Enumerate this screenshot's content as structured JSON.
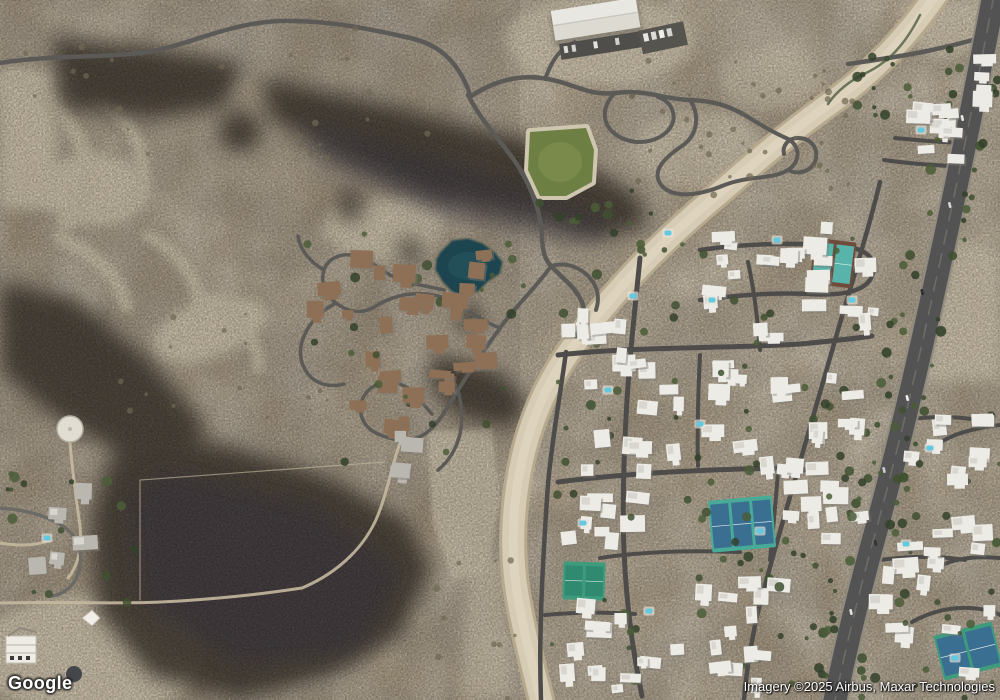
{
  "watermark": {
    "logo_text": "Google"
  },
  "attribution": {
    "text": "Imagery ©2025 Airbus, Maxar Technologies"
  },
  "colors": {
    "desert": "#b4a286",
    "desert_light": "#c7b99e",
    "sand": "#d5cab3",
    "mountain": "#453d34",
    "mountain_tint": "#3e3a46",
    "road": "#5b5a57",
    "road_dark": "#4d4c4a",
    "dirt_road": "#c6b99f",
    "wash": "#d6cbb4",
    "wash_edge": "#b6a98e",
    "highway": "#535353",
    "highway_shoulder": "#8f8b80",
    "lake": "#1c4450",
    "lake_light": "#2a5a64",
    "pool": "#62c9e0",
    "park": "#6e7f44",
    "tree": "#3f5030",
    "scrub": "#6d6753",
    "building": "#ecebe6",
    "building_shadow": "#7e7b74",
    "roof_brown": "#8d7055",
    "roof_gray": "#b9b7b0"
  },
  "map_features": {
    "residential_clusters": [
      {
        "x": 905,
        "y": 100,
        "w": 62,
        "h": 64,
        "n": 9
      },
      {
        "x": 966,
        "y": 52,
        "w": 32,
        "h": 58,
        "n": 4
      },
      {
        "x": 695,
        "y": 216,
        "w": 185,
        "h": 132,
        "n": 22
      },
      {
        "x": 560,
        "y": 298,
        "w": 132,
        "h": 118,
        "n": 14
      },
      {
        "x": 698,
        "y": 358,
        "w": 178,
        "h": 118,
        "n": 20
      },
      {
        "x": 556,
        "y": 416,
        "w": 138,
        "h": 138,
        "n": 15
      },
      {
        "x": 778,
        "y": 478,
        "w": 92,
        "h": 88,
        "n": 9
      },
      {
        "x": 550,
        "y": 598,
        "w": 112,
        "h": 98,
        "n": 12
      },
      {
        "x": 663,
        "y": 563,
        "w": 128,
        "h": 132,
        "n": 14
      },
      {
        "x": 903,
        "y": 388,
        "w": 97,
        "h": 102,
        "n": 10
      },
      {
        "x": 868,
        "y": 505,
        "w": 132,
        "h": 195,
        "n": 16
      }
    ],
    "mansion_clusters": [
      {
        "x": 332,
        "y": 238,
        "w": 205,
        "h": 98,
        "n": 13,
        "roof": "brown"
      },
      {
        "x": 348,
        "y": 334,
        "w": 165,
        "h": 102,
        "n": 9,
        "roof": "brown"
      },
      {
        "x": 272,
        "y": 278,
        "w": 72,
        "h": 42,
        "n": 3,
        "roof": "brown"
      },
      {
        "x": 362,
        "y": 428,
        "w": 100,
        "h": 52,
        "n": 4,
        "roof": "gray"
      },
      {
        "x": 330,
        "y": 352,
        "w": 150,
        "h": 60,
        "n": 5,
        "roof": "brown"
      },
      {
        "x": 8,
        "y": 482,
        "w": 100,
        "h": 95,
        "n": 5,
        "roof": "gray"
      }
    ],
    "tree_zones": [
      {
        "x": 896,
        "y": 30,
        "w": 100,
        "h": 670,
        "n": 70,
        "type": "hwy"
      },
      {
        "x": 552,
        "y": 235,
        "w": 330,
        "h": 450,
        "n": 85,
        "type": "tree"
      },
      {
        "x": 856,
        "y": 48,
        "w": 86,
        "h": 72,
        "n": 14,
        "type": "tree"
      },
      {
        "x": 536,
        "y": 188,
        "w": 120,
        "h": 72,
        "n": 14,
        "type": "tree"
      },
      {
        "x": 618,
        "y": 58,
        "w": 235,
        "h": 150,
        "n": 40,
        "type": "scrub"
      },
      {
        "x": 0,
        "y": 28,
        "w": 430,
        "h": 130,
        "n": 26,
        "type": "scrub"
      },
      {
        "x": 298,
        "y": 228,
        "w": 235,
        "h": 255,
        "n": 26,
        "type": "tree"
      },
      {
        "x": 0,
        "y": 468,
        "w": 145,
        "h": 135,
        "n": 16,
        "type": "tree"
      },
      {
        "x": 884,
        "y": 378,
        "w": 116,
        "h": 322,
        "n": 30,
        "type": "tree"
      },
      {
        "x": 430,
        "y": 560,
        "w": 90,
        "h": 140,
        "n": 10,
        "type": "scrub"
      },
      {
        "x": 86,
        "y": 300,
        "w": 250,
        "h": 120,
        "n": 18,
        "type": "scrub"
      }
    ],
    "pools": [
      {
        "x": 633,
        "y": 296
      },
      {
        "x": 668,
        "y": 233
      },
      {
        "x": 700,
        "y": 424
      },
      {
        "x": 760,
        "y": 531
      },
      {
        "x": 649,
        "y": 611
      },
      {
        "x": 583,
        "y": 523
      },
      {
        "x": 906,
        "y": 544
      },
      {
        "x": 921,
        "y": 130
      },
      {
        "x": 608,
        "y": 390
      },
      {
        "x": 852,
        "y": 300
      },
      {
        "x": 47,
        "y": 538
      },
      {
        "x": 777,
        "y": 240
      },
      {
        "x": 955,
        "y": 658
      },
      {
        "x": 930,
        "y": 448
      },
      {
        "x": 712,
        "y": 300
      }
    ],
    "tennis_courts": [
      {
        "x": 812,
        "y": 240,
        "w": 42,
        "h": 46,
        "rot": 7,
        "pad": "#6f4b3c",
        "court": "#58b4ab",
        "n": 2
      },
      {
        "x": 710,
        "y": 498,
        "w": 64,
        "h": 52,
        "rot": -5,
        "pad": "#47ab97",
        "court": "#3a6f92",
        "n": 3
      },
      {
        "x": 563,
        "y": 562,
        "w": 42,
        "h": 38,
        "rot": 2,
        "pad": "#3e9c7d",
        "court": "#2f8a70",
        "n": 2
      },
      {
        "x": 938,
        "y": 628,
        "w": 60,
        "h": 46,
        "rot": -14,
        "pad": "#3e9c7d",
        "court": "#3a6f92",
        "n": 2
      }
    ],
    "highway_cars": [
      {
        "y": 118,
        "lane": -4,
        "color": "#e8e8e8"
      },
      {
        "y": 205,
        "lane": 3,
        "color": "#d8d8d8"
      },
      {
        "y": 292,
        "lane": -5,
        "color": "#2e2e2e"
      },
      {
        "y": 398,
        "lane": 4,
        "color": "#eeeeee"
      },
      {
        "y": 470,
        "lane": -3,
        "color": "#cccccc"
      },
      {
        "y": 543,
        "lane": 5,
        "color": "#333333"
      },
      {
        "y": 612,
        "lane": -4,
        "color": "#e4e4e4"
      }
    ]
  }
}
